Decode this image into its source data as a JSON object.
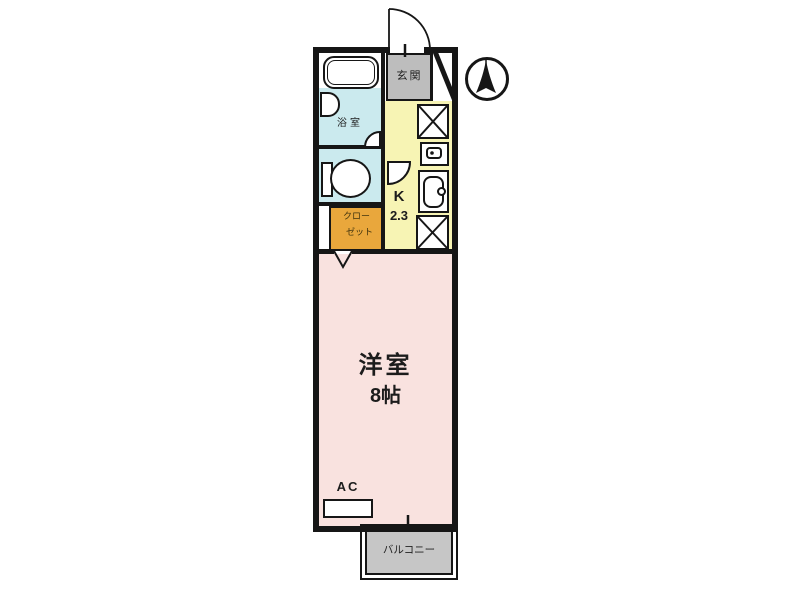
{
  "floorplan": {
    "entrance": {
      "label": "玄関",
      "color": "#bdbdbd"
    },
    "bathroom": {
      "label": "浴室",
      "color": "#cbeaee"
    },
    "closet": {
      "label_line1": "クロー",
      "label_line2": "ゼット",
      "color": "#e9a73c"
    },
    "kitchen": {
      "label": "K",
      "area": "2.3",
      "color": "#f7f4b4"
    },
    "main_room": {
      "label": "洋室",
      "area": "8帖",
      "color": "#f9e2df"
    },
    "ac": {
      "label": "AC"
    },
    "balcony": {
      "label": "バルコニー",
      "color": "#c6c6c6"
    },
    "wall_color": "#161616",
    "fixtures": [
      "bathtub",
      "washbasin",
      "toilet",
      "washing-machine-space",
      "stove",
      "kitchen-sink",
      "refrigerator-space"
    ],
    "compass": "north-arrow"
  }
}
